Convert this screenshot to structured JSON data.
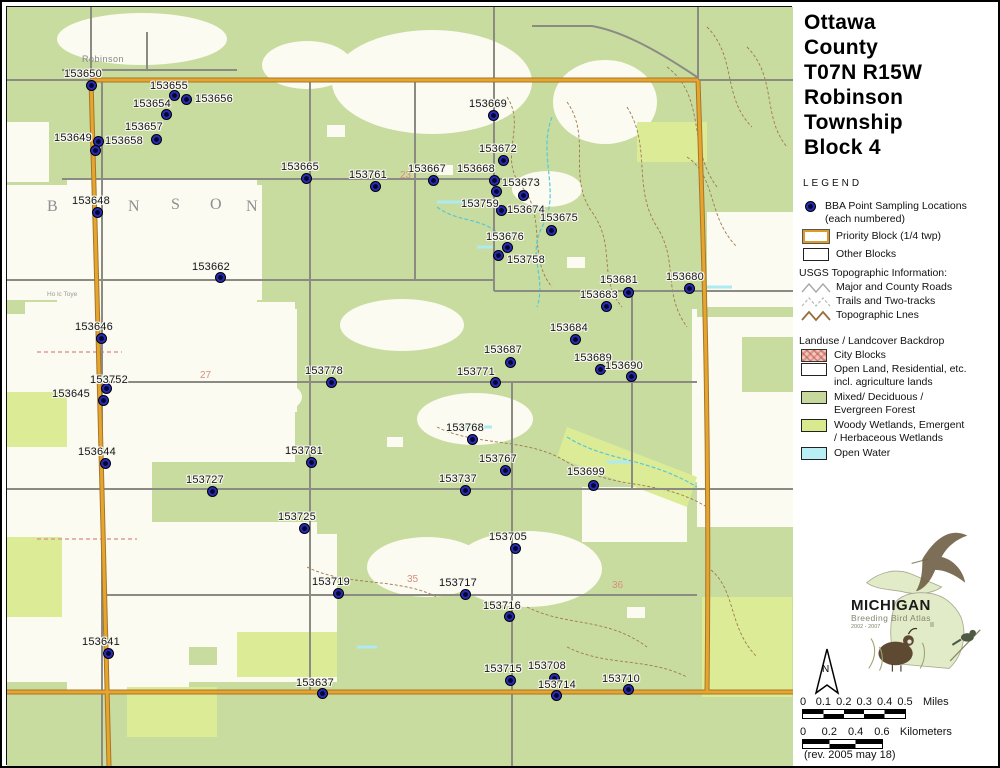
{
  "title_lines": [
    "Ottawa",
    "County",
    "T07N R15W",
    "Robinson",
    "Township",
    "Block 4"
  ],
  "legend": {
    "heading": "LEGEND",
    "bba_line1": "BBA Point Sampling Locations",
    "bba_line2": "(each numbered)",
    "priority_block": "Priority Block (1/4 twp)",
    "other_blocks": "Other Blocks",
    "usgs_heading": "USGS Topographic Information:",
    "roads": "Major and County Roads",
    "trails": "Trails and Two-tracks",
    "topo_lines": "Topographic Lnes",
    "landuse_heading": "Landuse / Landcover Backdrop",
    "city_blocks": "City Blocks",
    "open_land_1": "Open Land, Residential, etc.",
    "open_land_2": "incl. agriculture lands",
    "forest_1": "Mixed/ Deciduous /",
    "forest_2": "Evergreen Forest",
    "wetlands_1": "Woody Wetlands, Emergent",
    "wetlands_2": "/ Herbaceous Wetlands",
    "open_water": "Open Water"
  },
  "logo": {
    "name": "MICHIGAN",
    "subtitle": "Breeding Bird Atlas",
    "years": "2002 - 2007",
    "numeral": "II"
  },
  "north_label": "N",
  "scale_miles": {
    "ticks": [
      "0",
      "0.1",
      "0.2",
      "0.3",
      "0.4",
      "0.5"
    ],
    "unit": "Miles"
  },
  "scale_km": {
    "ticks": [
      "0",
      "0.2",
      "0.4",
      "0.6"
    ],
    "unit": "Kilometers"
  },
  "revision": "(rev. 2005 may 18)",
  "map": {
    "colors": {
      "point_blue": "#2a2ab5",
      "priority_orange": "#e5a62e",
      "forest_green": "#c9dc9f",
      "wetland_green": "#dcec96",
      "open_water_cyan": "#aeeaf2",
      "road_gray": "#8b8b84"
    },
    "points": [
      {
        "id": "153650",
        "x": 89,
        "y": 83,
        "lx": 62,
        "ly": 66
      },
      {
        "id": "153655",
        "x": 172,
        "y": 93,
        "lx": 148,
        "ly": 78
      },
      {
        "id": "153656",
        "x": 184,
        "y": 97,
        "lx": 193,
        "ly": 91
      },
      {
        "id": "153654",
        "x": 164,
        "y": 112,
        "lx": 131,
        "ly": 96
      },
      {
        "id": "153657",
        "x": 154,
        "y": 137,
        "lx": 123,
        "ly": 119
      },
      {
        "id": "153649",
        "x": 96,
        "y": 139,
        "lx": 52,
        "ly": 130
      },
      {
        "id": "153658",
        "x": 93,
        "y": 148,
        "lx": 103,
        "ly": 133
      },
      {
        "id": "153648",
        "x": 95,
        "y": 210,
        "lx": 70,
        "ly": 193
      },
      {
        "id": "153669",
        "x": 491,
        "y": 113,
        "lx": 467,
        "ly": 96
      },
      {
        "id": "153672",
        "x": 501,
        "y": 158,
        "lx": 477,
        "ly": 141
      },
      {
        "id": "153665",
        "x": 304,
        "y": 176,
        "lx": 279,
        "ly": 159
      },
      {
        "id": "153761",
        "x": 373,
        "y": 184,
        "lx": 347,
        "ly": 167
      },
      {
        "id": "153667",
        "x": 431,
        "y": 178,
        "lx": 406,
        "ly": 161
      },
      {
        "id": "153668",
        "x": 492,
        "y": 178,
        "lx": 455,
        "ly": 161
      },
      {
        "id": "153673",
        "x": 494,
        "y": 189,
        "lx": 500,
        "ly": 175
      },
      {
        "id": "153674",
        "x": 521,
        "y": 193,
        "lx": 505,
        "ly": 202
      },
      {
        "id": "153759",
        "x": 499,
        "y": 208,
        "lx": 459,
        "ly": 196
      },
      {
        "id": "153675",
        "x": 549,
        "y": 228,
        "lx": 538,
        "ly": 210
      },
      {
        "id": "153676",
        "x": 505,
        "y": 245,
        "lx": 484,
        "ly": 229
      },
      {
        "id": "153758",
        "x": 496,
        "y": 253,
        "lx": 505,
        "ly": 252
      },
      {
        "id": "153662",
        "x": 218,
        "y": 275,
        "lx": 190,
        "ly": 259
      },
      {
        "id": "153681",
        "x": 626,
        "y": 290,
        "lx": 598,
        "ly": 272
      },
      {
        "id": "153680",
        "x": 687,
        "y": 286,
        "lx": 664,
        "ly": 269
      },
      {
        "id": "153683",
        "x": 604,
        "y": 304,
        "lx": 578,
        "ly": 287
      },
      {
        "id": "153684",
        "x": 573,
        "y": 337,
        "lx": 548,
        "ly": 320
      },
      {
        "id": "153687",
        "x": 508,
        "y": 360,
        "lx": 482,
        "ly": 342
      },
      {
        "id": "153771",
        "x": 493,
        "y": 380,
        "lx": 455,
        "ly": 364
      },
      {
        "id": "153689",
        "x": 598,
        "y": 367,
        "lx": 572,
        "ly": 350
      },
      {
        "id": "153690",
        "x": 629,
        "y": 374,
        "lx": 603,
        "ly": 358
      },
      {
        "id": "153646",
        "x": 99,
        "y": 336,
        "lx": 73,
        "ly": 319
      },
      {
        "id": "153752",
        "x": 104,
        "y": 386,
        "lx": 88,
        "ly": 372
      },
      {
        "id": "153645",
        "x": 101,
        "y": 398,
        "lx": 50,
        "ly": 386
      },
      {
        "id": "153778",
        "x": 329,
        "y": 380,
        "lx": 303,
        "ly": 363
      },
      {
        "id": "153768",
        "x": 470,
        "y": 437,
        "lx": 444,
        "ly": 420
      },
      {
        "id": "153644",
        "x": 103,
        "y": 461,
        "lx": 76,
        "ly": 444
      },
      {
        "id": "153781",
        "x": 309,
        "y": 460,
        "lx": 283,
        "ly": 443
      },
      {
        "id": "153767",
        "x": 503,
        "y": 468,
        "lx": 477,
        "ly": 451
      },
      {
        "id": "153737",
        "x": 463,
        "y": 488,
        "lx": 437,
        "ly": 471
      },
      {
        "id": "153699",
        "x": 591,
        "y": 483,
        "lx": 565,
        "ly": 464
      },
      {
        "id": "153727",
        "x": 210,
        "y": 489,
        "lx": 184,
        "ly": 472
      },
      {
        "id": "153725",
        "x": 302,
        "y": 526,
        "lx": 276,
        "ly": 509
      },
      {
        "id": "153705",
        "x": 513,
        "y": 546,
        "lx": 487,
        "ly": 529
      },
      {
        "id": "153719",
        "x": 336,
        "y": 591,
        "lx": 310,
        "ly": 574
      },
      {
        "id": "153717",
        "x": 463,
        "y": 592,
        "lx": 437,
        "ly": 575
      },
      {
        "id": "153716",
        "x": 507,
        "y": 614,
        "lx": 481,
        "ly": 598
      },
      {
        "id": "153641",
        "x": 106,
        "y": 651,
        "lx": 80,
        "ly": 634
      },
      {
        "id": "153637",
        "x": 320,
        "y": 691,
        "lx": 294,
        "ly": 675
      },
      {
        "id": "153715",
        "x": 508,
        "y": 678,
        "lx": 482,
        "ly": 661
      },
      {
        "id": "153708",
        "x": 552,
        "y": 676,
        "lx": 526,
        "ly": 658
      },
      {
        "id": "153714",
        "x": 554,
        "y": 693,
        "lx": 536,
        "ly": 677
      },
      {
        "id": "153710",
        "x": 626,
        "y": 687,
        "lx": 600,
        "ly": 671
      }
    ],
    "watermark_letters": [
      {
        "t": "B",
        "x": 45,
        "y": 196
      },
      {
        "t": "N",
        "x": 126,
        "y": 196
      },
      {
        "t": "S",
        "x": 169,
        "y": 194
      },
      {
        "t": "O",
        "x": 208,
        "y": 194
      },
      {
        "t": "N",
        "x": 244,
        "y": 196
      }
    ],
    "section_numbers": [
      {
        "t": "23",
        "x": 398,
        "y": 168
      },
      {
        "t": "27",
        "x": 198,
        "y": 368
      },
      {
        "t": "35",
        "x": 405,
        "y": 572
      },
      {
        "t": "36",
        "x": 610,
        "y": 578
      }
    ],
    "place_labels": [
      {
        "t": "Robinson",
        "x": 80,
        "y": 52,
        "cls": "place-town"
      },
      {
        "t": "Ho lc Toye",
        "x": 45,
        "y": 289,
        "cls": "place-tiny"
      }
    ]
  }
}
